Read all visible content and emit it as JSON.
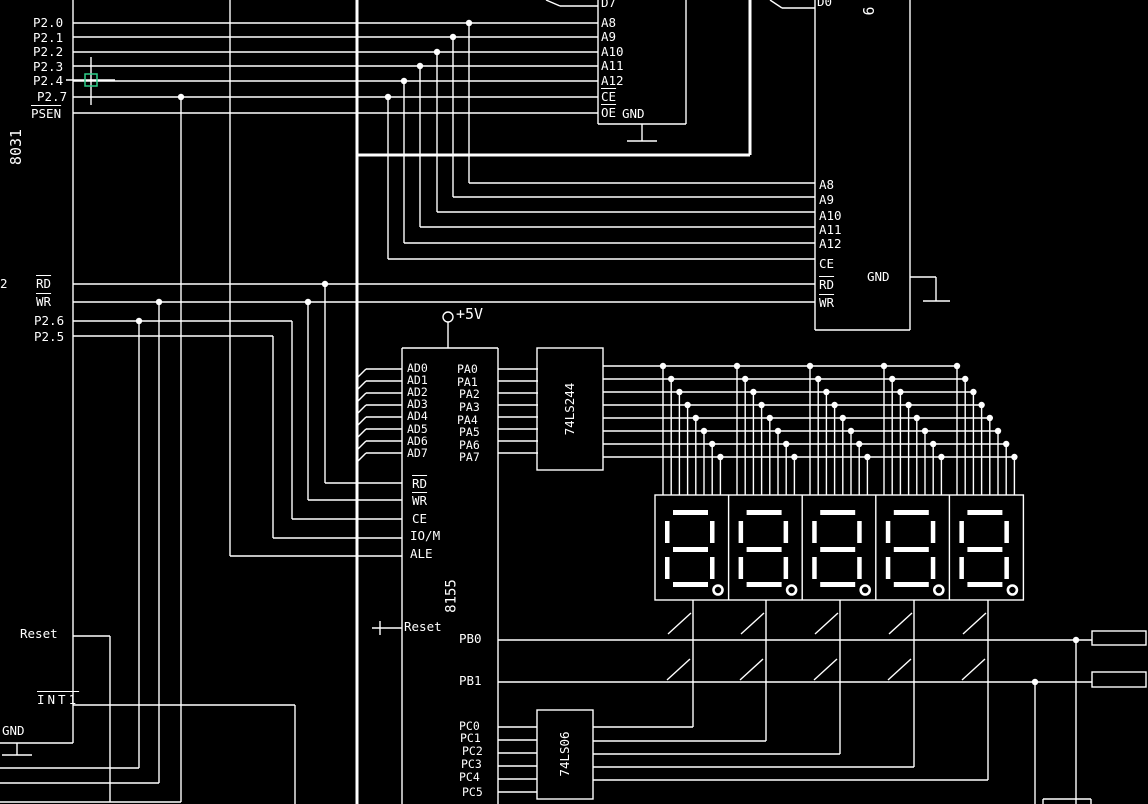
{
  "cursor": {
    "color": "#2fcf8a"
  },
  "cpu_8031": {
    "chip_label": "8031",
    "edge_label": "2",
    "port_pins": [
      "P2.0",
      "P2.1",
      "P2.2",
      "P2.3",
      "P2.4",
      "P2.7"
    ],
    "psen": "PSEN",
    "rd": "RD",
    "wr": "WR",
    "p26": "P2.6",
    "p25": "P2.5",
    "reset": "Reset",
    "int1": "INT1",
    "gnd": "GND"
  },
  "eprom": {
    "d7": "D7",
    "addr": [
      "A8",
      "A9",
      "A10",
      "A11",
      "A12"
    ],
    "ce": "CE",
    "oe": "OE",
    "gnd": "GND"
  },
  "sram": {
    "chip_label": "6",
    "d0": "D0",
    "addr": [
      "A8",
      "A9",
      "A10",
      "A11",
      "A12"
    ],
    "ce": "CE",
    "rd": "RD",
    "wr": "WR",
    "gnd": "GND"
  },
  "power": {
    "vcc_label": "+5V"
  },
  "pio_8155": {
    "chip_label": "8155",
    "ad_pins": [
      "AD0",
      "AD1",
      "AD2",
      "AD3",
      "AD4",
      "AD5",
      "AD6",
      "AD7"
    ],
    "ctrl_pins": [
      "RD",
      "WR",
      "CE",
      "IO/M",
      "ALE"
    ],
    "reset": "Reset",
    "pa_pins": [
      "PA0",
      "PA1",
      "PA2",
      "PA3",
      "PA4",
      "PA5",
      "PA6",
      "PA7"
    ],
    "pb_pins": [
      "PB0",
      "PB1"
    ],
    "pc_pins": [
      "PC0",
      "PC1",
      "PC2",
      "PC3",
      "PC4",
      "PC5"
    ]
  },
  "buffer_74ls244": {
    "chip_label": "74LS244"
  },
  "driver_74ls06": {
    "chip_label": "74LS06"
  },
  "display": {
    "digit_count": 5
  }
}
